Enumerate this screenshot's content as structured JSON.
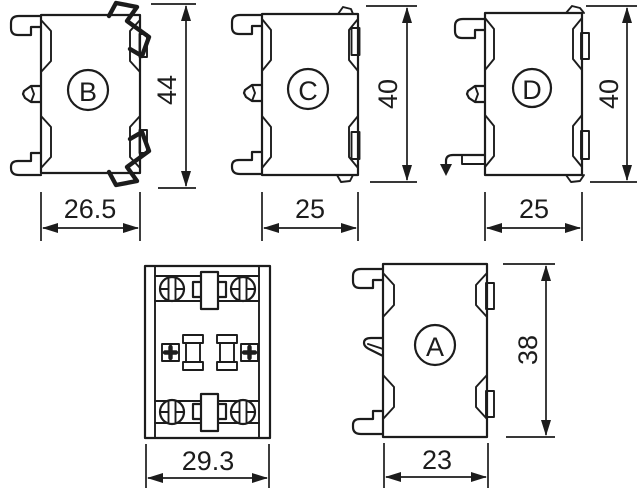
{
  "diagram": {
    "background_color": "#ffffff",
    "line_color": "#1c1c1c",
    "views": {
      "b": {
        "label": "B",
        "height_dim": "44",
        "width_dim": "26.5"
      },
      "c": {
        "label": "C",
        "height_dim": "40",
        "width_dim": "25"
      },
      "d": {
        "label": "D",
        "height_dim": "40",
        "width_dim": "25"
      },
      "front": {
        "width_dim": "29.3"
      },
      "a": {
        "label": "A",
        "height_dim": "38",
        "width_dim": "23"
      }
    }
  }
}
